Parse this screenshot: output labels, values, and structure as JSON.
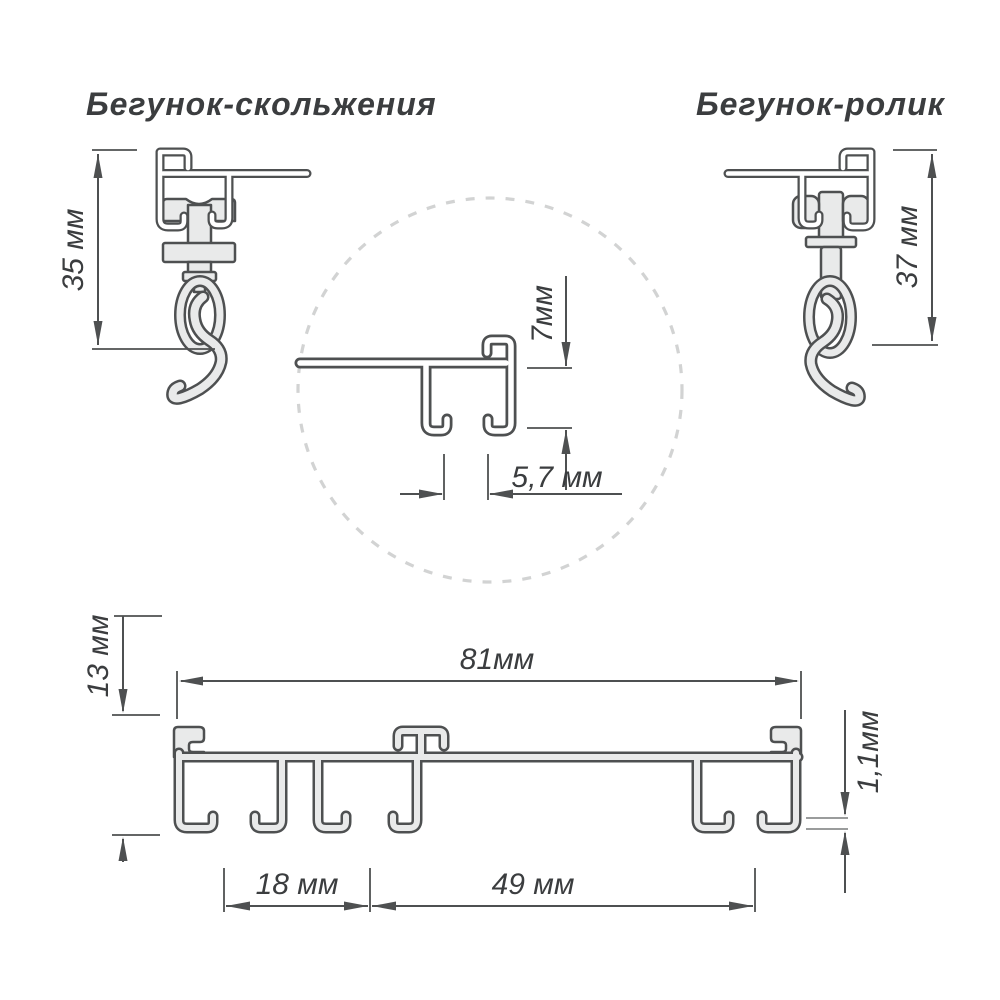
{
  "titles": {
    "left": "Бегунок-скольжения",
    "right": "Бегунок-ролик"
  },
  "dimensions": {
    "slider_height": "35 мм",
    "roller_height": "37 мм",
    "detail_height": "7мм",
    "detail_slot": "5,7 мм",
    "profile_height": "13 мм",
    "profile_width": "81мм",
    "foot_thickness": "1,1мм",
    "channel1_width": "18 мм",
    "channel2_width": "49 мм"
  },
  "colors": {
    "line": "#4e5051",
    "metal_fill": "#e9eaea",
    "dashed_circle": "#d2d3d3",
    "text": "#3b3d3f",
    "background": "#ffffff"
  }
}
